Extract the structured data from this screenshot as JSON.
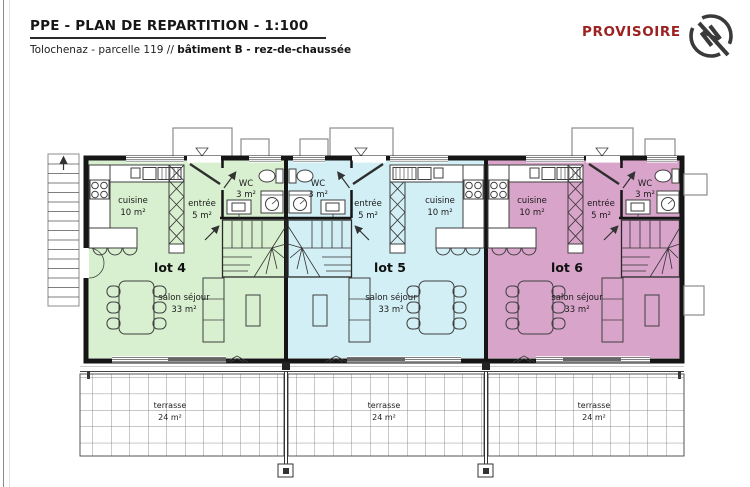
{
  "header": {
    "title": "PPE - PLAN DE REPARTITION - 1:100",
    "subtitle_prefix": "Tolochenaz - parcelle 119 // ",
    "subtitle_bold": "bâtiment B - rez-de-chaussée",
    "status": "PROVISOIRE",
    "status_color": "#9c2121",
    "compass_letter": "N"
  },
  "plan": {
    "lots": [
      {
        "label": "lot 4",
        "fill": "#d8f0cf",
        "cuisine_name": "cuisine",
        "cuisine_area": "10 m²",
        "entree_name": "entrée",
        "entree_area": "5 m²",
        "wc_name": "WC",
        "wc_area": "3 m²",
        "salon_name": "salon séjour",
        "salon_area": "33 m²",
        "terrasse_name": "terrasse",
        "terrasse_area": "24 m²"
      },
      {
        "label": "lot 5",
        "fill": "#d2eff5",
        "cuisine_name": "cuisine",
        "cuisine_area": "10 m²",
        "entree_name": "entrée",
        "entree_area": "5 m²",
        "wc_name": "WC",
        "wc_area": "3 m²",
        "salon_name": "salon séjour",
        "salon_area": "33 m²",
        "terrasse_name": "terrasse",
        "terrasse_area": "24 m²"
      },
      {
        "label": "lot 6",
        "fill": "#d9a4ca",
        "cuisine_name": "cuisine",
        "cuisine_area": "10 m²",
        "entree_name": "entrée",
        "entree_area": "5 m²",
        "wc_name": "WC",
        "wc_area": "3 m²",
        "salon_name": "salon séjour",
        "salon_area": "33 m²",
        "terrasse_name": "terrasse",
        "terrasse_area": "24 m²"
      }
    ]
  }
}
